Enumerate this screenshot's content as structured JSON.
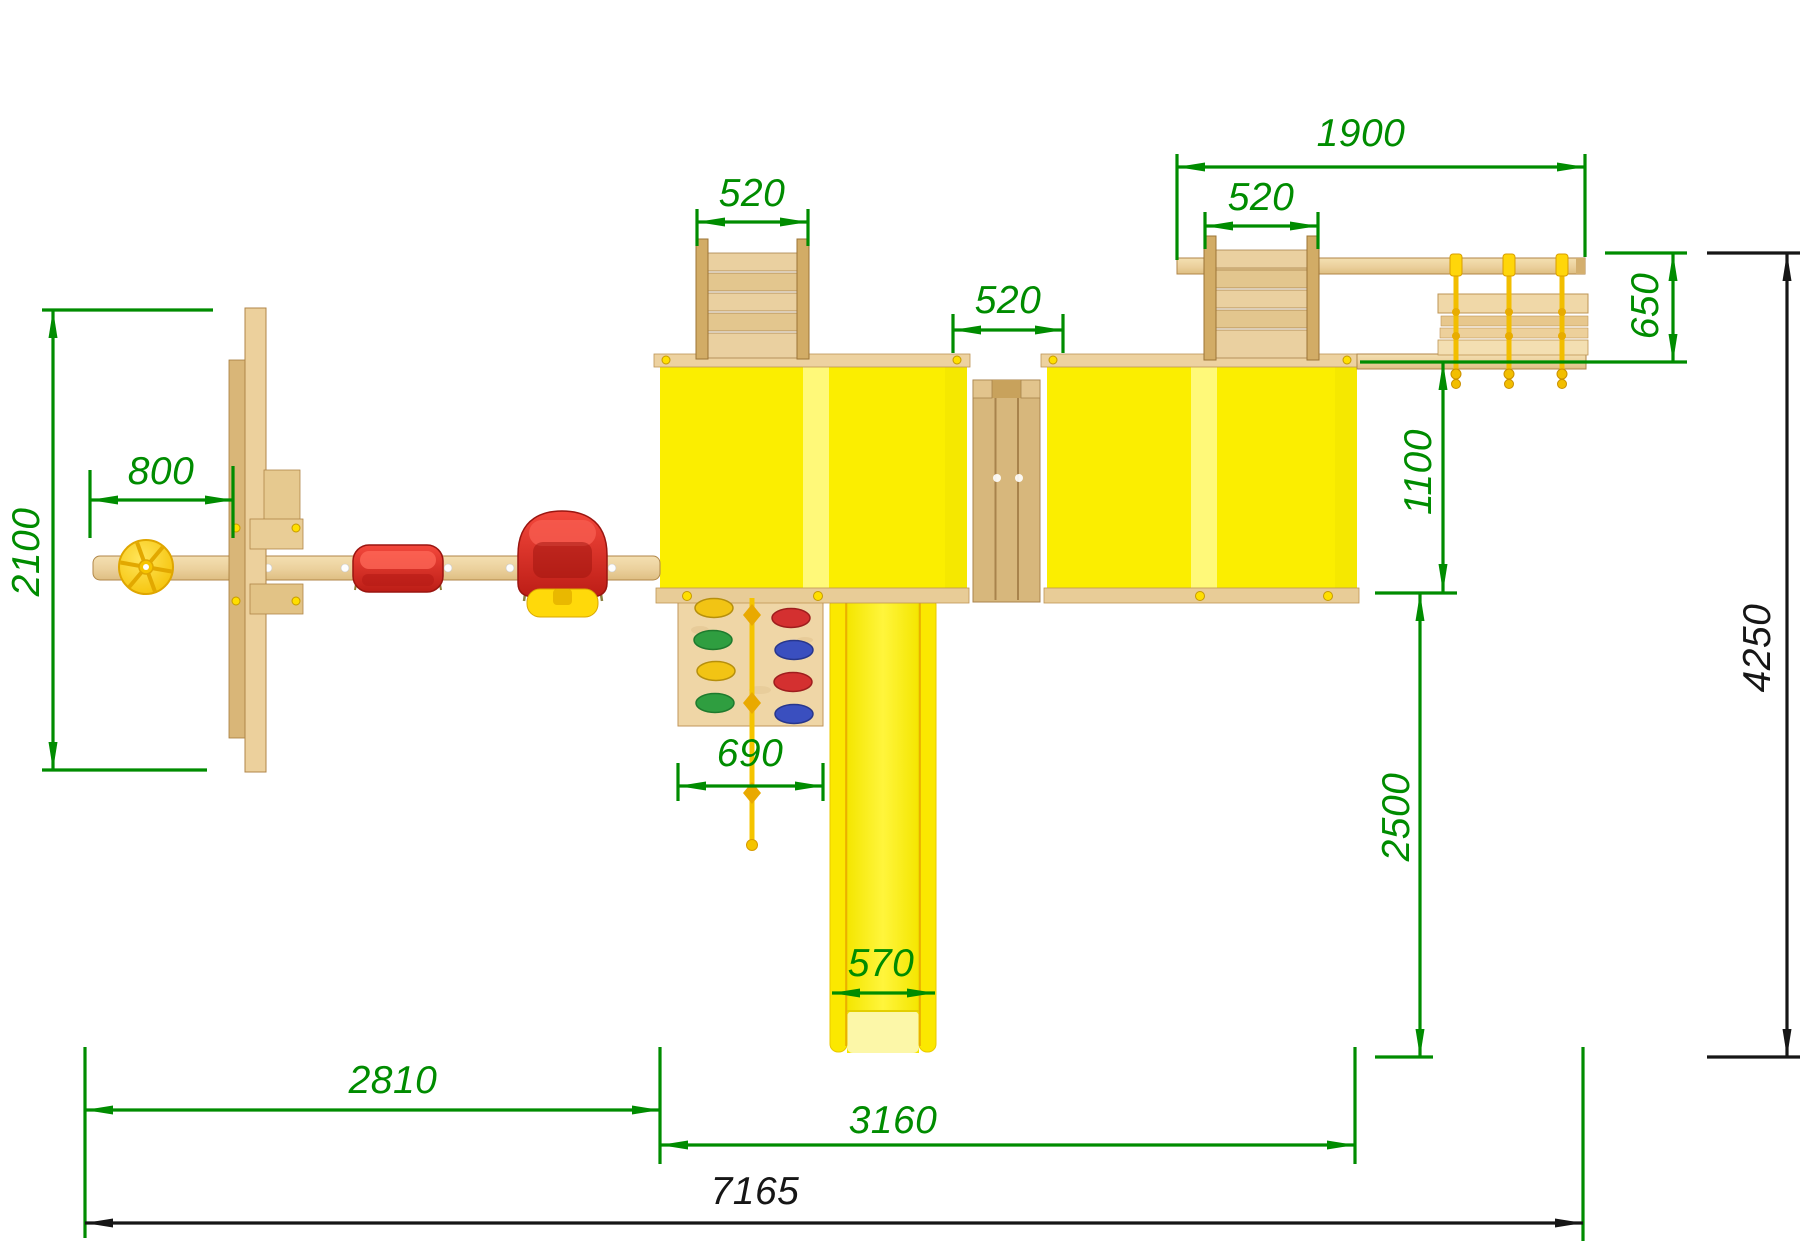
{
  "page": {
    "kind": "CAD top-view plan drawing of a wooden children's playground complex",
    "background": "#FFFFFF",
    "units": "mm"
  },
  "colors": {
    "dimension_green": "#008C00",
    "dimension_black": "#161616",
    "wood_light": "#F0D8A6",
    "wood_dark": "#C9A05E",
    "roof_yellow": "#FBEE00",
    "roof_stripe": "#FFFA86",
    "slide_yellow": "#FFF200",
    "swing_red": "#D9261E",
    "rope_yellow": "#F2BE00",
    "hold_yellow": "#F2C414",
    "hold_green": "#2F9E40",
    "hold_red": "#D43030",
    "hold_blue": "#3A4FBF"
  },
  "dims": {
    "d800": {
      "label": "800",
      "value": 800,
      "orientation": "horizontal",
      "color": "green"
    },
    "d2100": {
      "label": "2100",
      "value": 2100,
      "orientation": "vertical",
      "color": "green"
    },
    "d520_left": {
      "label": "520",
      "value": 520,
      "orientation": "horizontal",
      "color": "green"
    },
    "d520_mid": {
      "label": "520",
      "value": 520,
      "orientation": "horizontal",
      "color": "green"
    },
    "d520_right": {
      "label": "520",
      "value": 520,
      "orientation": "horizontal",
      "color": "green"
    },
    "d1900": {
      "label": "1900",
      "value": 1900,
      "orientation": "horizontal",
      "color": "green"
    },
    "d650": {
      "label": "650",
      "value": 650,
      "orientation": "vertical",
      "color": "green"
    },
    "d1100": {
      "label": "1100",
      "value": 1100,
      "orientation": "vertical",
      "color": "green"
    },
    "d2500": {
      "label": "2500",
      "value": 2500,
      "orientation": "vertical",
      "color": "green"
    },
    "d690": {
      "label": "690",
      "value": 690,
      "orientation": "horizontal",
      "color": "green"
    },
    "d570": {
      "label": "570",
      "value": 570,
      "orientation": "horizontal",
      "color": "green"
    },
    "d2810": {
      "label": "2810",
      "value": 2810,
      "orientation": "horizontal",
      "color": "green"
    },
    "d3160": {
      "label": "3160",
      "value": 3160,
      "orientation": "horizontal",
      "color": "green"
    },
    "d7165": {
      "label": "7165",
      "value": 7165,
      "orientation": "horizontal",
      "color": "black"
    },
    "d4250": {
      "label": "4250",
      "value": 4250,
      "orientation": "vertical",
      "color": "black"
    }
  },
  "components": [
    "swing-beam",
    "a-frame-post",
    "steering-wheel",
    "flat-swing-seat",
    "baby-swing-seat",
    "left-tower-roof",
    "right-tower-roof",
    "bridge",
    "left-ladder",
    "right-ladder",
    "climbing-wall",
    "climbing-rope",
    "slide",
    "monkey-beam",
    "hanging-bench",
    "rope-knots"
  ]
}
